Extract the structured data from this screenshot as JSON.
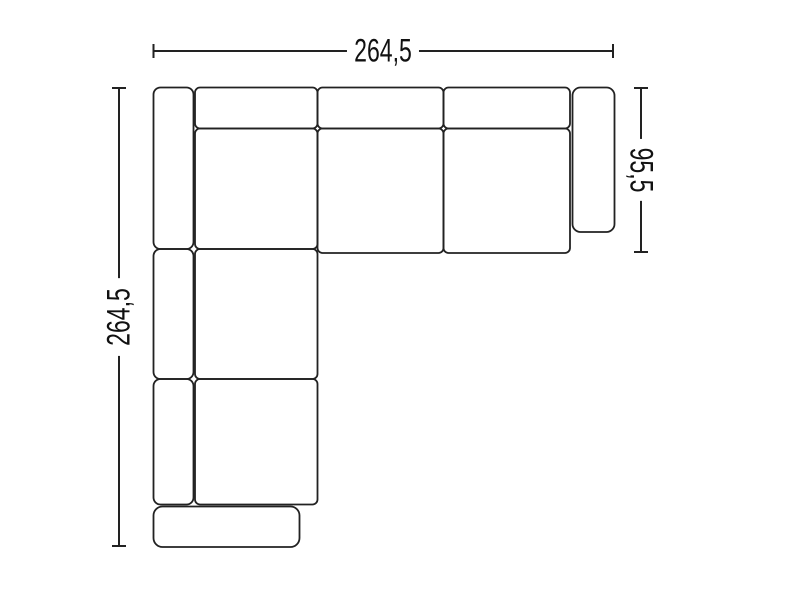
{
  "page": {
    "description": "Top-view technical line drawing of a corner sofa with overall dimensions",
    "background": "#ffffff"
  },
  "colors": {
    "line": "#222222",
    "text": "#111111",
    "label_background": "#ffffff"
  },
  "dimensions": {
    "top": {
      "label": "264,5",
      "orientation": "horizontal",
      "measures": "overall width"
    },
    "left": {
      "label": "264,5",
      "orientation": "vertical",
      "measures": "overall depth of left section"
    },
    "right": {
      "label": "95,5",
      "orientation": "vertical",
      "measures": "depth of right section"
    }
  },
  "diagram": {
    "type": "furniture-floor-plan",
    "subject": "modular corner sofa seen from above",
    "modules": [
      "left-backrest-top",
      "corner-backrest",
      "corner-seat",
      "middle-seat-backrest",
      "middle-seat",
      "right-seat-backrest",
      "right-seat",
      "right-armrest",
      "left-backrest-middle",
      "left-backrest-bottom",
      "lower-seat-1",
      "lower-seat-2",
      "bottom-armrest"
    ]
  }
}
